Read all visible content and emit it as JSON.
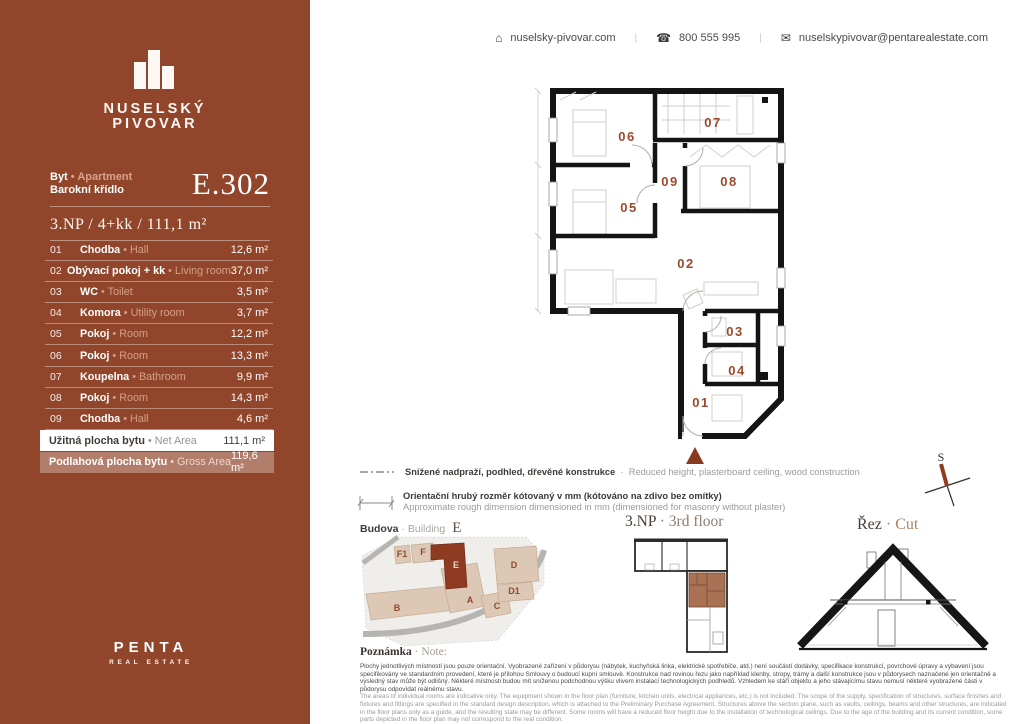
{
  "colors": {
    "sidebar": "#91462b",
    "accent": "#8a3a20",
    "room_label": "#9b4a2c",
    "highlight_building": "#8e3b22"
  },
  "header": {
    "website": "nuselsky-pivovar.com",
    "phone": "800 555 995",
    "email": "nuselskypivovar@pentarealestate.com",
    "separator": "|",
    "icons": [
      "home-icon",
      "phone-icon",
      "mail-icon"
    ]
  },
  "sidebar": {
    "brand_line1": "NUSELSKÝ",
    "brand_line2": "PIVOVAR",
    "unit_type_cs": "Byt",
    "unit_type_sep": "•",
    "unit_type_en": "Apartment",
    "unit_wing": "Barokní křídlo",
    "unit_code": "E.302",
    "spec": "3.NP / 4+kk / 111,1 m²",
    "rooms": [
      {
        "num": "01",
        "cs": "Chodba",
        "sep": "•",
        "en": "Hall",
        "area": "12,6 m²"
      },
      {
        "num": "02",
        "cs": "Obývací pokoj + kk",
        "sep": "•",
        "en": "Living room",
        "area": "37,0 m²"
      },
      {
        "num": "03",
        "cs": "WC",
        "sep": "•",
        "en": "Toilet",
        "area": "3,5 m²"
      },
      {
        "num": "04",
        "cs": "Komora",
        "sep": "•",
        "en": "Utility room",
        "area": "3,7 m²"
      },
      {
        "num": "05",
        "cs": "Pokoj",
        "sep": "•",
        "en": "Room",
        "area": "12,2 m²"
      },
      {
        "num": "06",
        "cs": "Pokoj",
        "sep": "•",
        "en": "Room",
        "area": "13,3 m²"
      },
      {
        "num": "07",
        "cs": "Koupelna",
        "sep": "•",
        "en": "Bathroom",
        "area": "9,9 m²"
      },
      {
        "num": "08",
        "cs": "Pokoj",
        "sep": "•",
        "en": "Room",
        "area": "14,3 m²"
      },
      {
        "num": "09",
        "cs": "Chodba",
        "sep": "•",
        "en": "Hall",
        "area": "4,6 m²"
      }
    ],
    "net": {
      "cs": "Užitná plocha bytu",
      "sep": "•",
      "en": "Net Area",
      "area": "111,1 m²"
    },
    "gross": {
      "cs": "Podlahová plocha bytu",
      "sep": "•",
      "en": "Gross Area",
      "area": "119,6 m²"
    },
    "footer_brand": "PENTA",
    "footer_sub": "REAL ESTATE"
  },
  "plan": {
    "labels": {
      "r01": "01",
      "r02": "02",
      "r03": "03",
      "r04": "04",
      "r05": "05",
      "r06": "06",
      "r07": "07",
      "r08": "08",
      "r09": "09"
    }
  },
  "legend": {
    "row1_cs": "Snížené nadpraží, podhled, dřevěné konstrukce",
    "row1_sep": "·",
    "row1_en": "Reduced height, plasterboard ceiling, wood construction",
    "row2_cs": "Orientační hrubý rozměr kótovaný v mm (kótováno na zdivo bez omítky)",
    "row2_en": "Approximate rough dimension dimensioned in mm (dimensioned for masonry without plaster)"
  },
  "captions": {
    "building_cs": "Budova",
    "building_sep": "·",
    "building_en": "Building",
    "building_value": "E",
    "floor_cs": "3.NP",
    "floor_sep": "·",
    "floor_en": "3rd floor",
    "cut_cs": "Řez",
    "cut_sep": "·",
    "cut_en": "Cut",
    "compass": "S"
  },
  "siteplan": {
    "labels": {
      "f1": "F1",
      "f": "F",
      "e": "E",
      "d": "D",
      "d1": "D1",
      "a": "A",
      "c": "C",
      "b": "B"
    }
  },
  "note": {
    "title_cs": "Poznámka",
    "title_sep": "·",
    "title_en": "Note:",
    "text_cs": "Plochy jednotlivých místností jsou pouze orientační. Vyobrazené zařízení v půdorysu (nábytek, kuchyňská linka, elektrické spotřebiče, atd.) není součástí dodávky, specifikace konstrukcí, povrchové úpravy a vybavení jsou specifikovány ve standardním provedení, které je přílohou Smlouvy o budoucí kupní smlouvě. Konstrukce nad rovinou řezu jako například klenby, stropy, trámy a další konstrukce jsou v půdorysech naznačené jen orientačně a výsledný stav může být odlišný. Některé místnosti budou mít sníženou podchodnou výšku vlivem instalací technologických podhledů. Vzhledem ke stáří objektu a jeho stávajícímu stavu nemusí některé vyobrazené části v půdorysu odpovídat reálnému stavu.",
    "text_en": "The areas of individual rooms are indicative only. The equipment shown in the floor plan (furniture, kitchen units, electrical appliances, etc.) is not included. The scope of the supply, specification of structures, surface finishes and fixtures and fittings are specified in the standard design description, which is attached to the Preliminary Purchase Agreement. Structures above the section plane, such as vaults, ceilings, beams and other structures, are indicated in the floor plans only as a guide, and the resulting state may be different. Some rooms will have a reduced floor height due to the installation of technological ceilings. Due to the age of the building and its current condition, some parts depicted in the floor plan may not correspond to the real condition."
  }
}
